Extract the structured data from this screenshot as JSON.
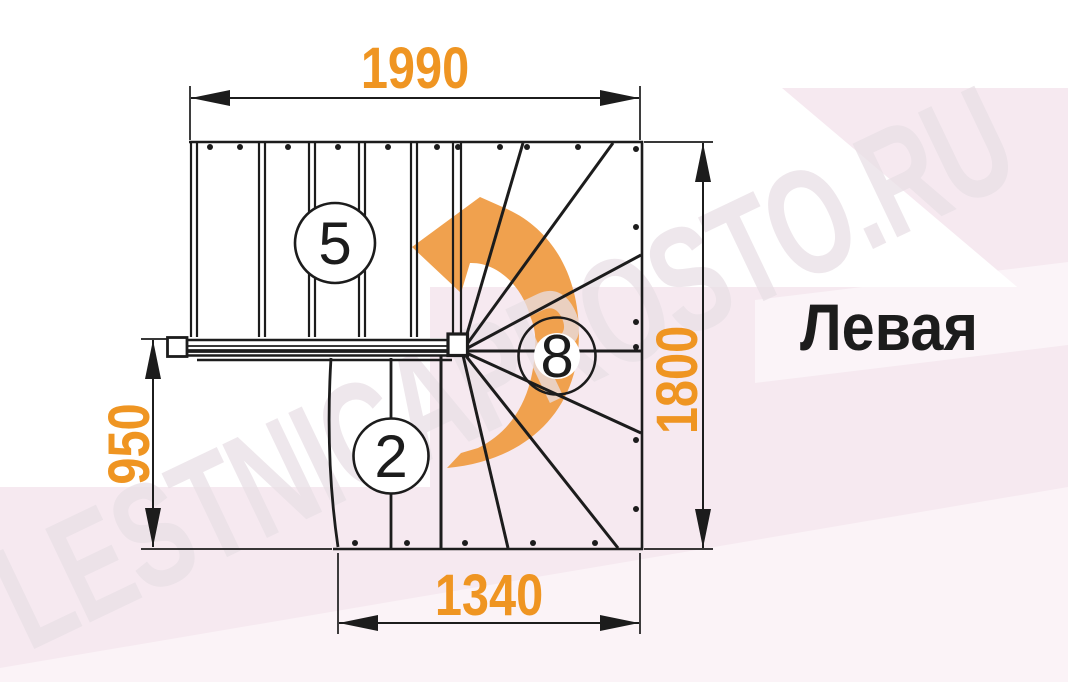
{
  "colors": {
    "accent_orange": "#EF9522",
    "arrow_orange": "#F0A14E",
    "ink_black": "#1C1C1C",
    "bg_white": "#FFFFFF",
    "bg_pink": "#F6E9F0",
    "bg_pink_light": "#FBF3F7",
    "watermark_gray": "#E9E0E6"
  },
  "diagram": {
    "orientation_label": "Левая",
    "watermark": "LESTNICAPROSTO.RU",
    "turn_arrow_icon": "curved-arrow-counterclockwise",
    "dimensions_mm": {
      "top_width": "1990",
      "right_height": "1800",
      "left_height": "950",
      "bottom_width": "1340"
    },
    "step_counts": {
      "upper_flight": "5",
      "winder_steps": "8",
      "lower_flight": "2"
    }
  }
}
